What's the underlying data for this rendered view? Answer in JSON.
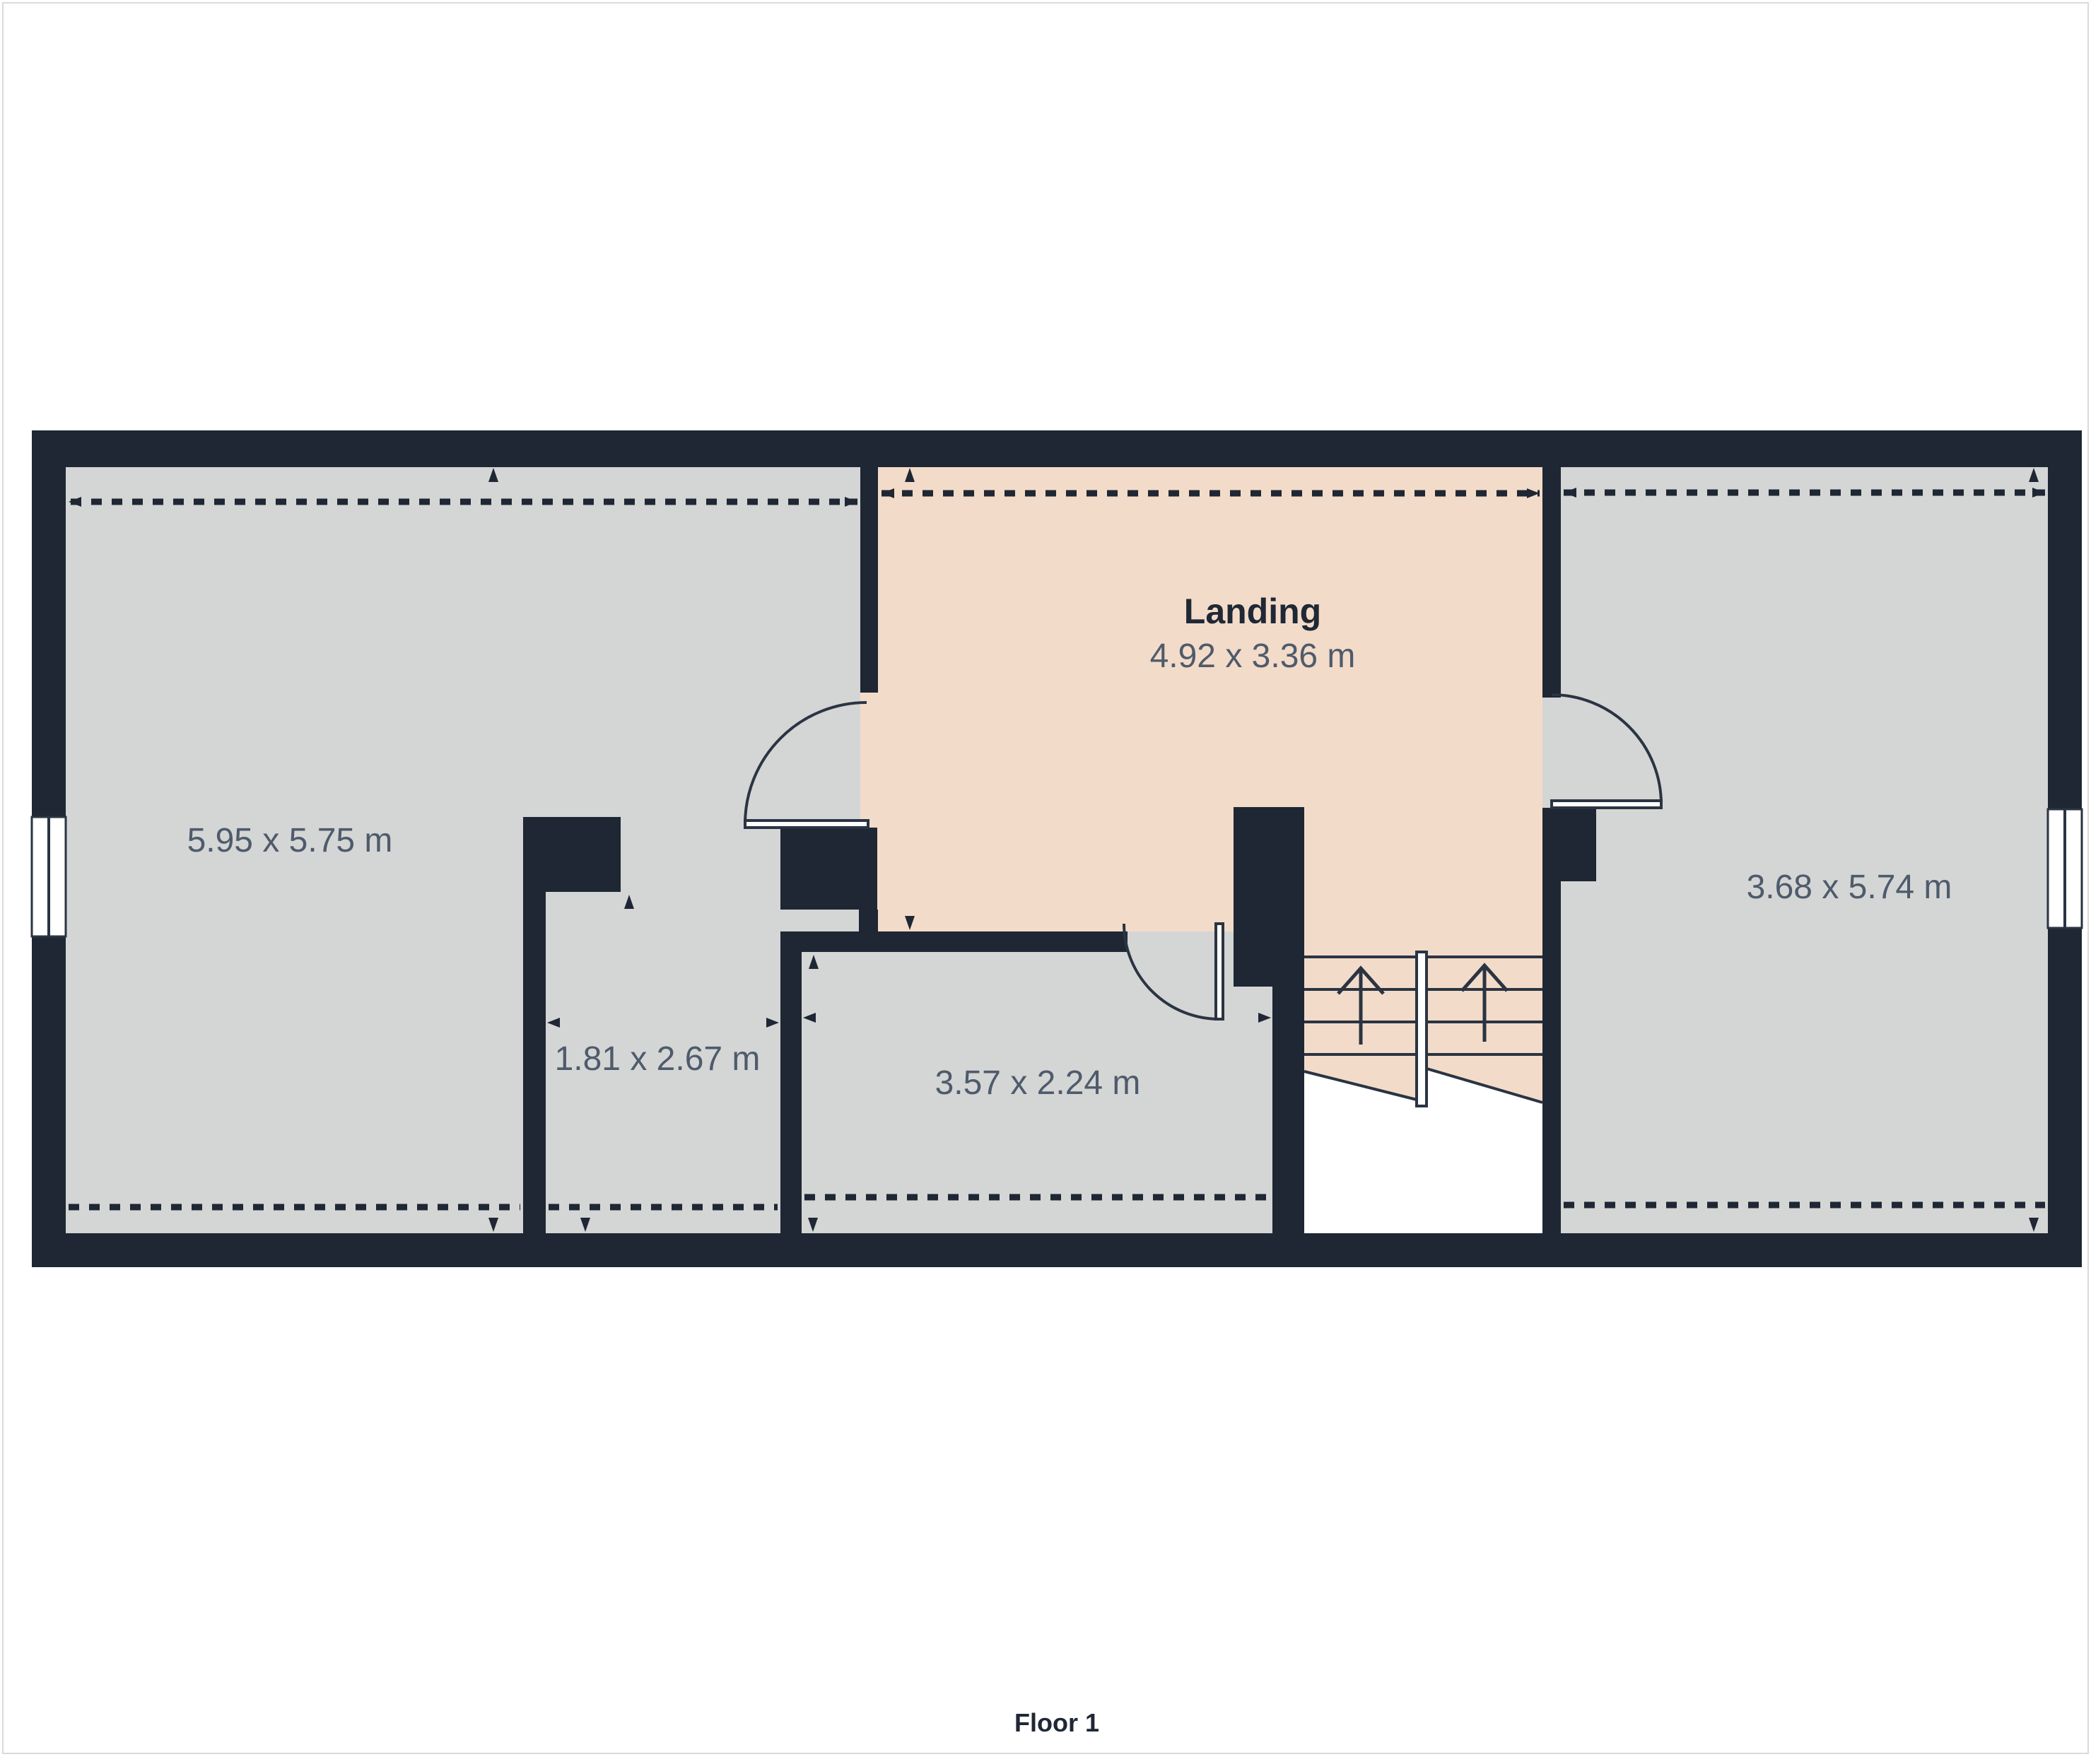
{
  "floor_label": "Floor 1",
  "rooms": {
    "left": {
      "dims": "5.95 x 5.75 m"
    },
    "landing": {
      "name": "Landing",
      "dims": "4.92 x 3.36 m"
    },
    "right": {
      "dims": "3.68 x 5.74 m"
    },
    "small_left": {
      "dims": "1.81 x 2.67 m"
    },
    "small_mid": {
      "dims": "3.57 x 2.24 m"
    }
  },
  "colors": {
    "wall": "#1e2733",
    "room_fill": "#d4d5d5",
    "landing_fill": "#f3dbc9",
    "outline": "#2a3442",
    "dim_text": "#4e5b6b",
    "title_text": "#1f2835",
    "page_border": "#d9dadb",
    "background": "#ffffff"
  }
}
